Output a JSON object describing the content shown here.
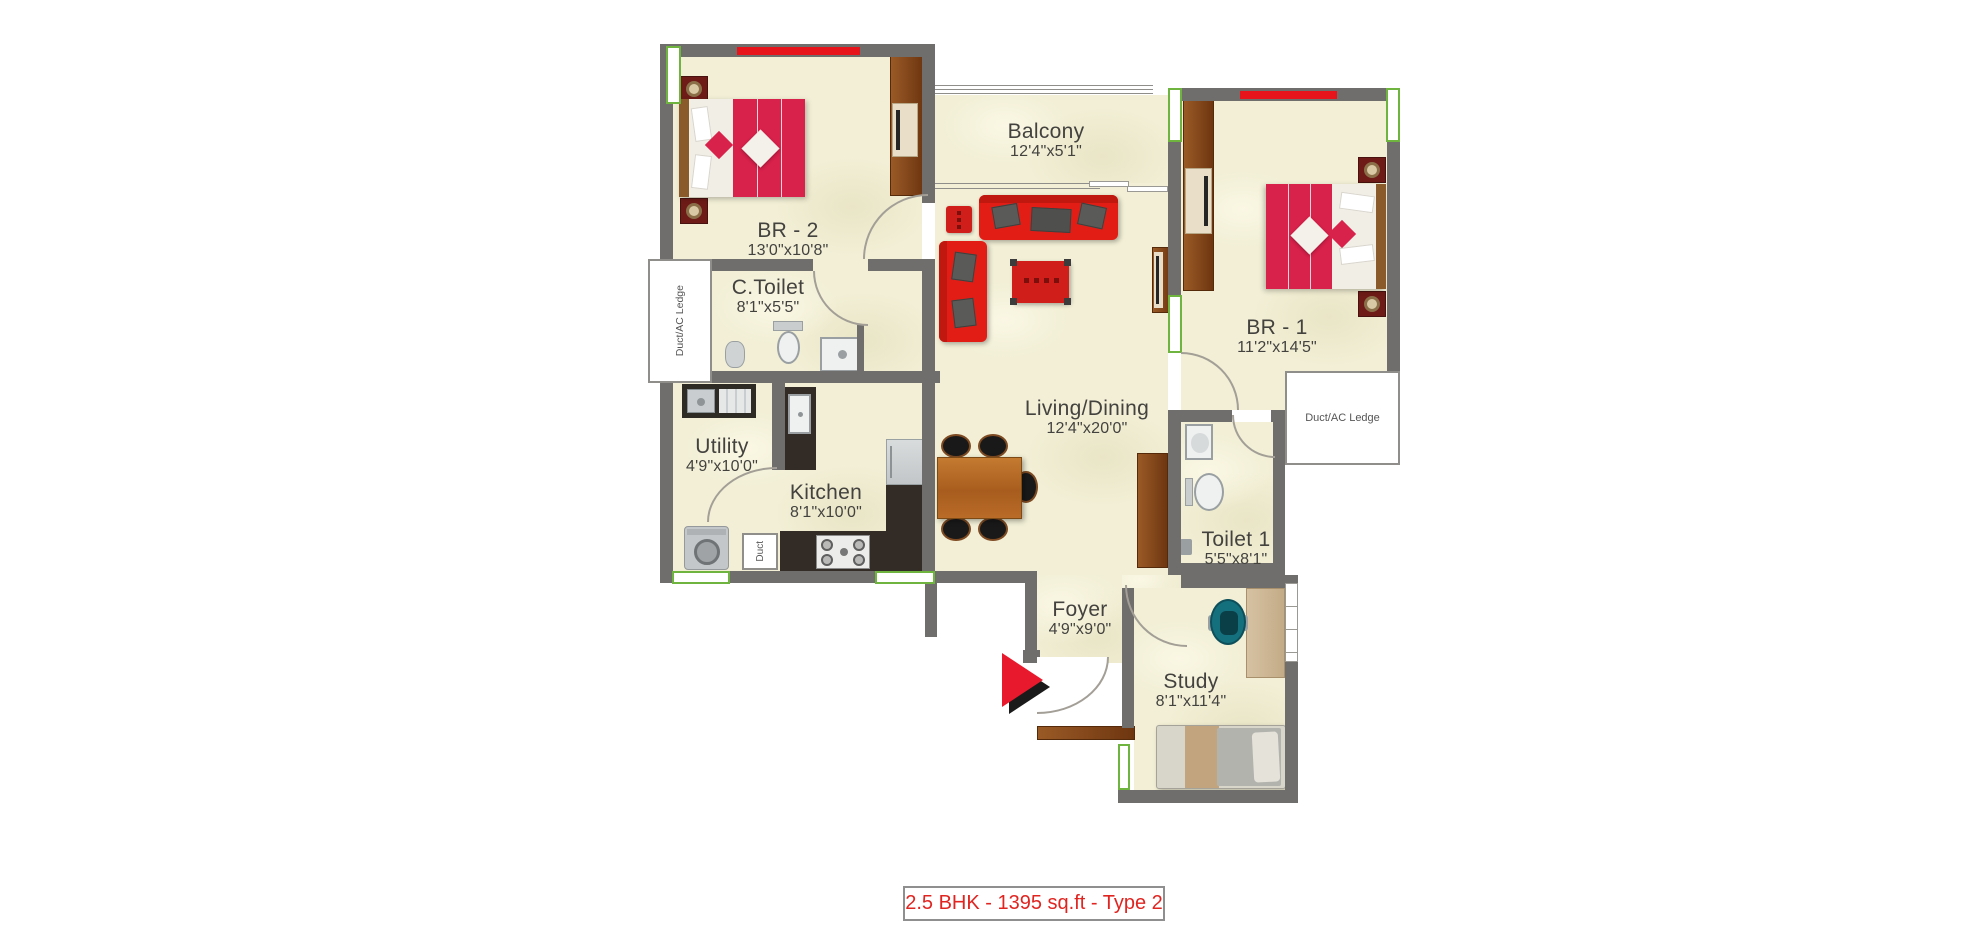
{
  "caption": "2.5 BHK - 1395 sq.ft - Type 2",
  "rooms": [
    {
      "name": "BR - 2",
      "dims": "13'0\"x10'8\""
    },
    {
      "name": "C.Toilet",
      "dims": "8'1\"x5'5\""
    },
    {
      "name": "Balcony",
      "dims": "12'4\"x5'1\""
    },
    {
      "name": "BR - 1",
      "dims": "11'2\"x14'5\""
    },
    {
      "name": "Living/Dining",
      "dims": "12'4\"x20'0\""
    },
    {
      "name": "Utility",
      "dims": "4'9\"x10'0\""
    },
    {
      "name": "Kitchen",
      "dims": "8'1\"x10'0\""
    },
    {
      "name": "Toilet 1",
      "dims": "5'5\"x8'1\""
    },
    {
      "name": "Foyer",
      "dims": "4'9\"x9'0\""
    },
    {
      "name": "Study",
      "dims": "8'1\"x11'4\""
    }
  ],
  "annotations": {
    "duct_ac_ledge_left": "Duct/AC Ledge",
    "duct_ac_ledge_right": "Duct/AC Ledge",
    "duct": "Duct"
  },
  "colors": {
    "wall": "#6f6e6c",
    "floor": "#f2efd6",
    "accent_red_strip": "#e8141c",
    "window_green": "#6fb43f",
    "bed_red": "#d8214b",
    "sofa_red": "#e21d16",
    "wood_brown": "#8a4a1f",
    "counter_dark": "#332c26",
    "teal_chair": "#15707e",
    "caption_red": "#e02521"
  }
}
